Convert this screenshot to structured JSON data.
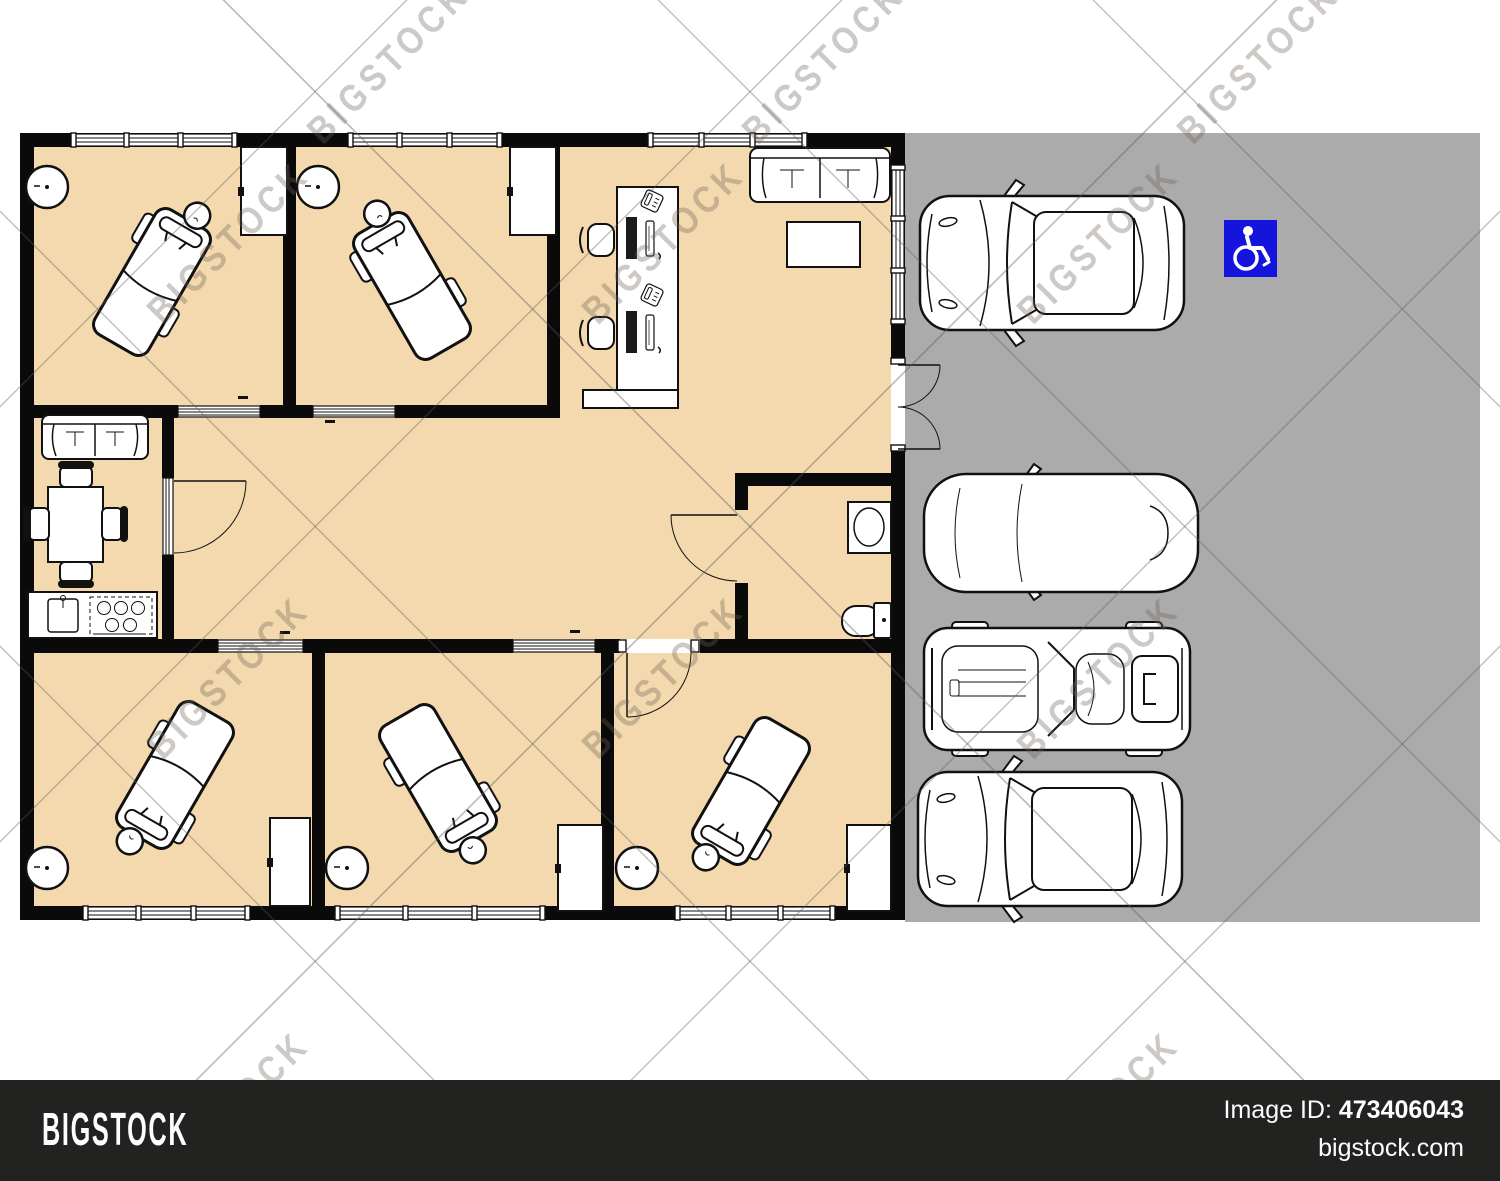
{
  "watermark": {
    "text": "BIGSTOCK"
  },
  "footer": {
    "logo": "BIGSTOCK",
    "image_id_label": "Image ID:",
    "image_id_value": "473406043",
    "site": "bigstock.com"
  },
  "colors": {
    "floor": "#f3d9ad",
    "parking": "#ababab",
    "wall": "#0a0a0a",
    "accessible_blue": "#1414dc",
    "footer_bg": "#222221"
  },
  "floor_plan": {
    "label": "massage-salon-floor-plan",
    "rooms": [
      {
        "name": "treatment-room-top-left",
        "furniture": [
          "massage-table",
          "corner-sink",
          "cabinet"
        ]
      },
      {
        "name": "treatment-room-top-middle",
        "furniture": [
          "massage-table",
          "corner-sink",
          "cabinet"
        ]
      },
      {
        "name": "reception",
        "furniture": [
          "reception-desk",
          "office-chair",
          "office-chair",
          "computer",
          "computer",
          "phone",
          "phone",
          "sofa",
          "coffee-table"
        ]
      },
      {
        "name": "staff-room",
        "furniture": [
          "sofa",
          "dining-table",
          "dining-chair",
          "dining-chair",
          "dining-chair",
          "dining-chair",
          "kitchen-counter",
          "kitchen-sink",
          "stove"
        ]
      },
      {
        "name": "hallway",
        "furniture": []
      },
      {
        "name": "bathroom",
        "furniture": [
          "wash-basin",
          "toilet"
        ]
      },
      {
        "name": "treatment-room-bottom-left",
        "furniture": [
          "massage-table",
          "corner-sink",
          "cabinet"
        ]
      },
      {
        "name": "treatment-room-bottom-middle",
        "furniture": [
          "massage-table",
          "corner-sink",
          "cabinet"
        ]
      },
      {
        "name": "treatment-room-bottom-right",
        "furniture": [
          "massage-table",
          "corner-sink",
          "cabinet"
        ]
      }
    ]
  },
  "parking": {
    "label": "parking-lot",
    "accessible_icon": "wheelchair-icon",
    "cars": [
      "suv-top-view",
      "hatchback-top-view",
      "classic-car-top-view",
      "suv-top-view"
    ]
  }
}
